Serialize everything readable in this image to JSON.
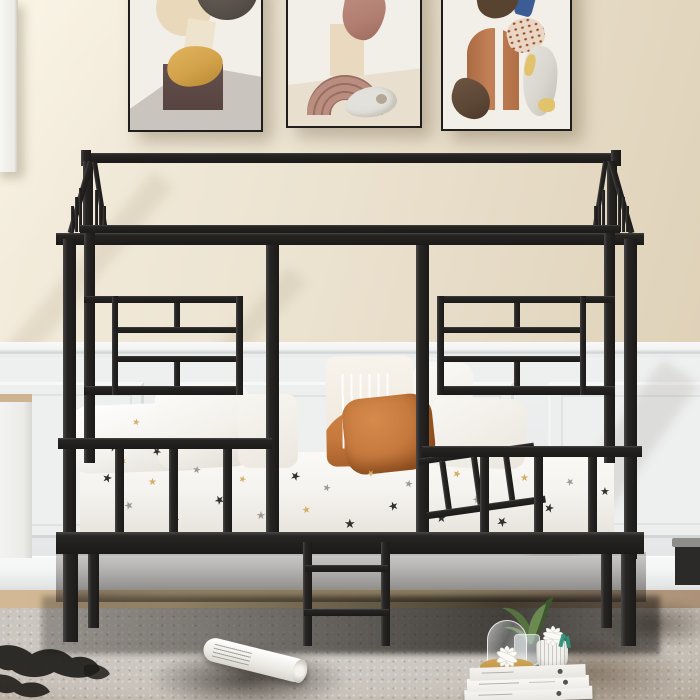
{
  "glyphs": {
    "star": "★"
  },
  "palette": {
    "wall": "#ece3d1",
    "wall_lit": "#f5eede",
    "wall_shade": "#dfd2b9",
    "black": "#262524",
    "black_hi": "#4a4846",
    "metal": "#1b1a19",
    "wainscot": "#eff1f1",
    "wainscot_dark": "#dadcdd",
    "panel": "#edefef",
    "baseboard": "#f5f6f6",
    "floor": "#c7ad8c",
    "floor_lit": "#eed7a8",
    "floor_dark": "#ab9279",
    "rug_light": "#d3d0cb",
    "rug_mid": "#c0b6a9",
    "rug_dark": "#988b7b",
    "rug_shape": "#201d1a",
    "rug_brown": "#5f5244",
    "bed_white": "#f5f3ef",
    "pillow_white": "#f3f0ea",
    "star_black": "#32302d",
    "star_gray": "#9d9a96",
    "star_gold": "#d4ae67",
    "orange": "#c67a3e",
    "orange_dark": "#9f5723",
    "canvas": "#f2efe8",
    "frame": "#1f1e1d",
    "p1_circle": "#ead8bb",
    "p1_square": "#eee3cc",
    "p1_dark": "#574f49",
    "p1_yellow": "#d2a24b",
    "p1_box": "#64504c",
    "p1_floor": "#c9c4bd",
    "p2_fabric": "#b27f72",
    "p2_pillar": "#e9dabf",
    "p2_arch": "#b98e80",
    "p2_arch_line": "#9a6e60",
    "p2_stone": "#e2e1dc",
    "p2_ground": "#e8dfcf",
    "p3_blob": "#57432f",
    "p3_blue": "#3c5c96",
    "p3_arch": "#c48157",
    "p3_dark": "#5c4636",
    "p3_dotted": "#e9d6c4",
    "p3_fabric": "#d9d6cf",
    "p3_yellow": "#e2c36d",
    "glass": "#dfe5e8",
    "gold_bowl": "#c59a4c",
    "plant": "#55713f",
    "plant_dark": "#3e5530",
    "teal": "#35957f",
    "wood_top": "#cdb392",
    "bench_top": "#8f8d89",
    "bench_body": "#2b2a28",
    "paper_white": "#fbfaf7"
  }
}
